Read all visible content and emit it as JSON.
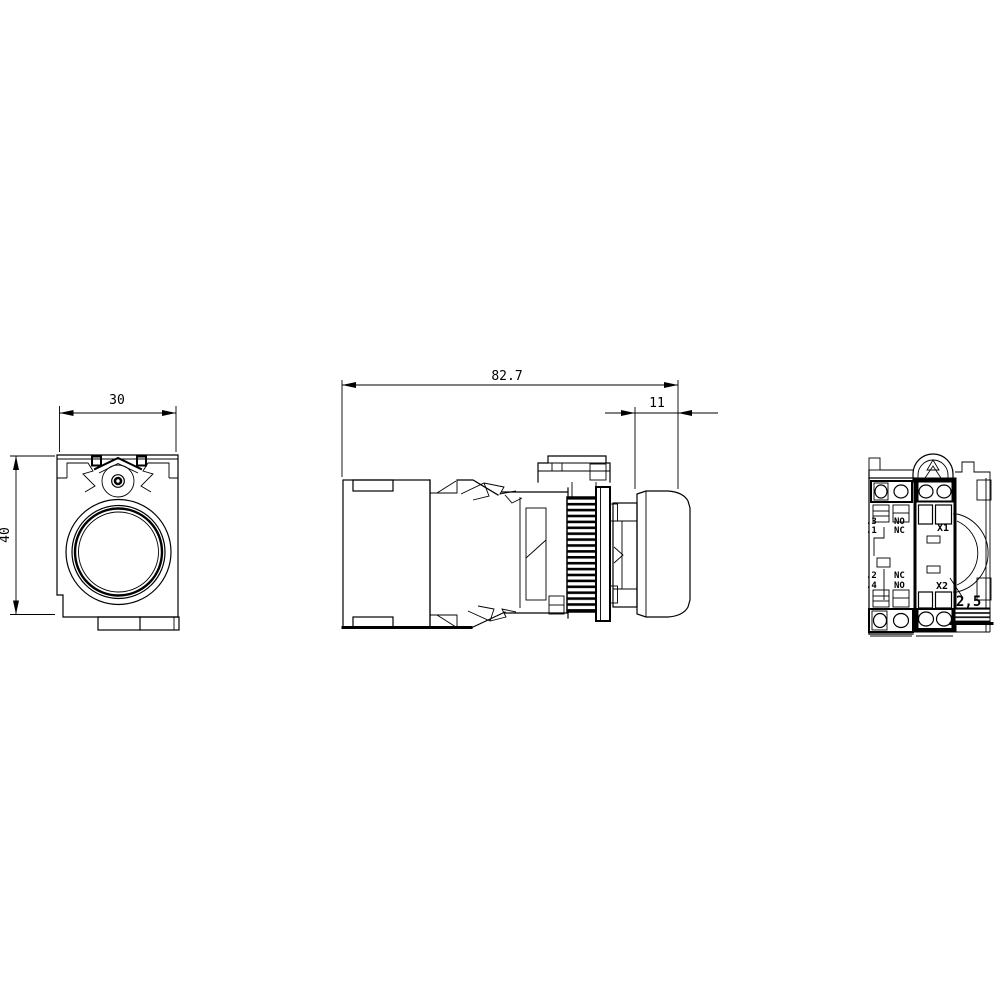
{
  "canvas": {
    "background": "#ffffff",
    "line_color": "#000000"
  },
  "dimensions": {
    "front_width": "30",
    "front_height": "40",
    "side_overall_length": "82.7",
    "side_button_depth": "11"
  },
  "rear": {
    "terminal_dot3": ".3",
    "terminal_dot1": ".1",
    "contact_no_upper": "NO",
    "contact_nc_upper": "NC",
    "terminal_dot2": ".2",
    "terminal_dot4": ".4",
    "contact_nc_lower": "NC",
    "contact_no_lower": "NO",
    "lamp_terminal_x1": "X1",
    "lamp_terminal_x2": "X2",
    "wire_cross_section": "2,5"
  }
}
